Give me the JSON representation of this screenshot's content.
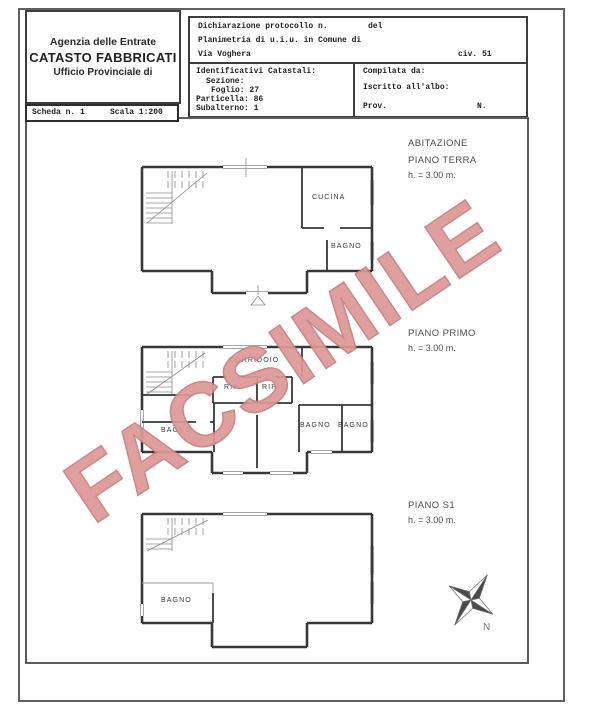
{
  "header": {
    "agency": {
      "line1": "Agenzia delle Entrate",
      "line2": "CATASTO FABBRICATI",
      "line3": "Ufficio Provinciale di"
    },
    "declaration": {
      "protocol": "Dichiarazione protocollo n.",
      "del": "del",
      "planimetria": "Planimetria di u.i.u. in Comune di",
      "street": "Via Voghera",
      "civic": "civ. 51"
    },
    "cadastral": {
      "title": "Identificativi Catastali:",
      "sezione": "Sezione:",
      "foglio": "Foglio: 27",
      "particella": "Particella: 86",
      "subalterno": "Subalterno: 1"
    },
    "compiled": {
      "by": "Compilata da:",
      "albo": "Iscritto all'albo:",
      "prov": "Prov.",
      "n": "N."
    }
  },
  "scheda": {
    "number": "Scheda n. 1",
    "scale": "Scala 1:200"
  },
  "floors": {
    "terra": {
      "title1": "ABITAZIONE",
      "title2": "PIANO TERRA",
      "height": "h. = 3.00 m."
    },
    "primo": {
      "title1": "PIANO PRIMO",
      "height": "h. = 3.00 m."
    },
    "s1": {
      "title1": "PIANO S1",
      "height": "h. = 3.00 m."
    }
  },
  "rooms": {
    "terra_cucina": "CUCINA",
    "terra_bagno": "BAGNO",
    "primo_corridoio": "CORRIDOIO",
    "primo_rip1": "RIP.",
    "primo_rip2": "RIP.",
    "primo_bagno1": "BAGNO",
    "primo_bagno2": "BAGNO",
    "primo_bagno3": "BAGNO",
    "s1_bagno": "BAGNO"
  },
  "watermark": {
    "text": "FACSIMILE",
    "color": "#dd9898"
  },
  "compass": {
    "label": "N"
  }
}
